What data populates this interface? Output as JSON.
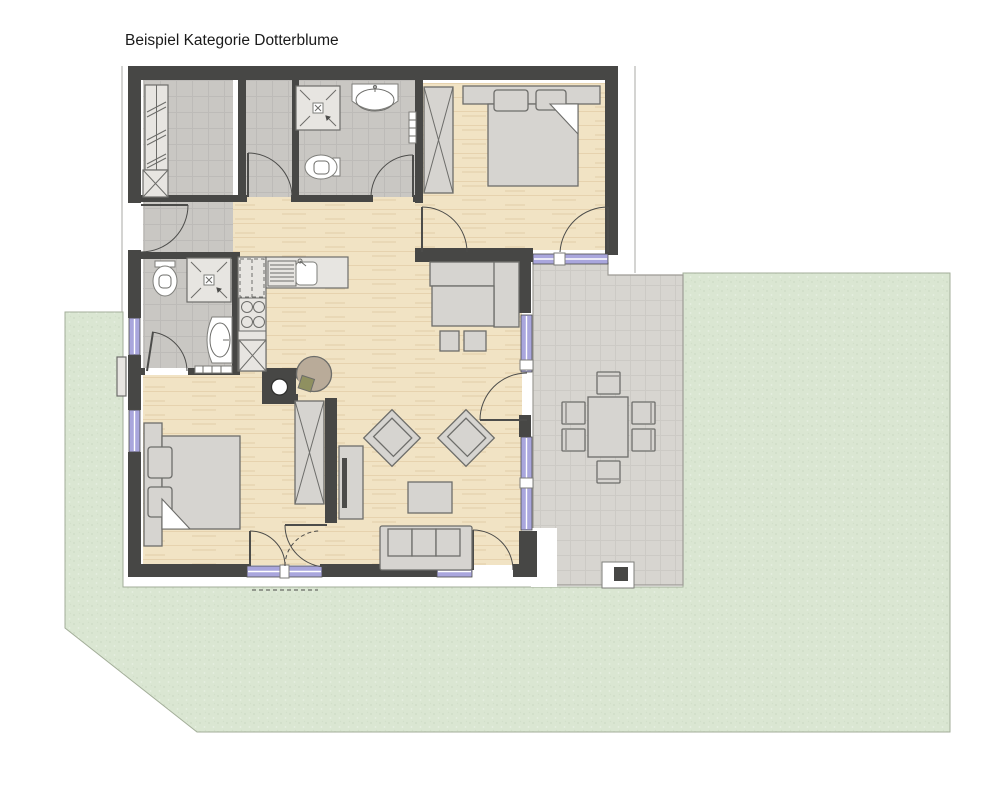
{
  "title": "Beispiel Kategorie Dotterblume",
  "palette": {
    "text": "#1a1a1a",
    "wall": "#474745",
    "wood_color": "#f1e3c4",
    "tile_color": "#c9c7c3",
    "terrace_color": "#d7d5d0",
    "garden": "#dae6d2",
    "garden_border": "#a3ae99",
    "window": "#a9a6dd",
    "furniture": "#d6d4d0",
    "outline": "#6d6d6a",
    "boundary": "#b8b8b3",
    "stove_tan": "#b9ab99",
    "cushion_olive": "#8f9060"
  }
}
